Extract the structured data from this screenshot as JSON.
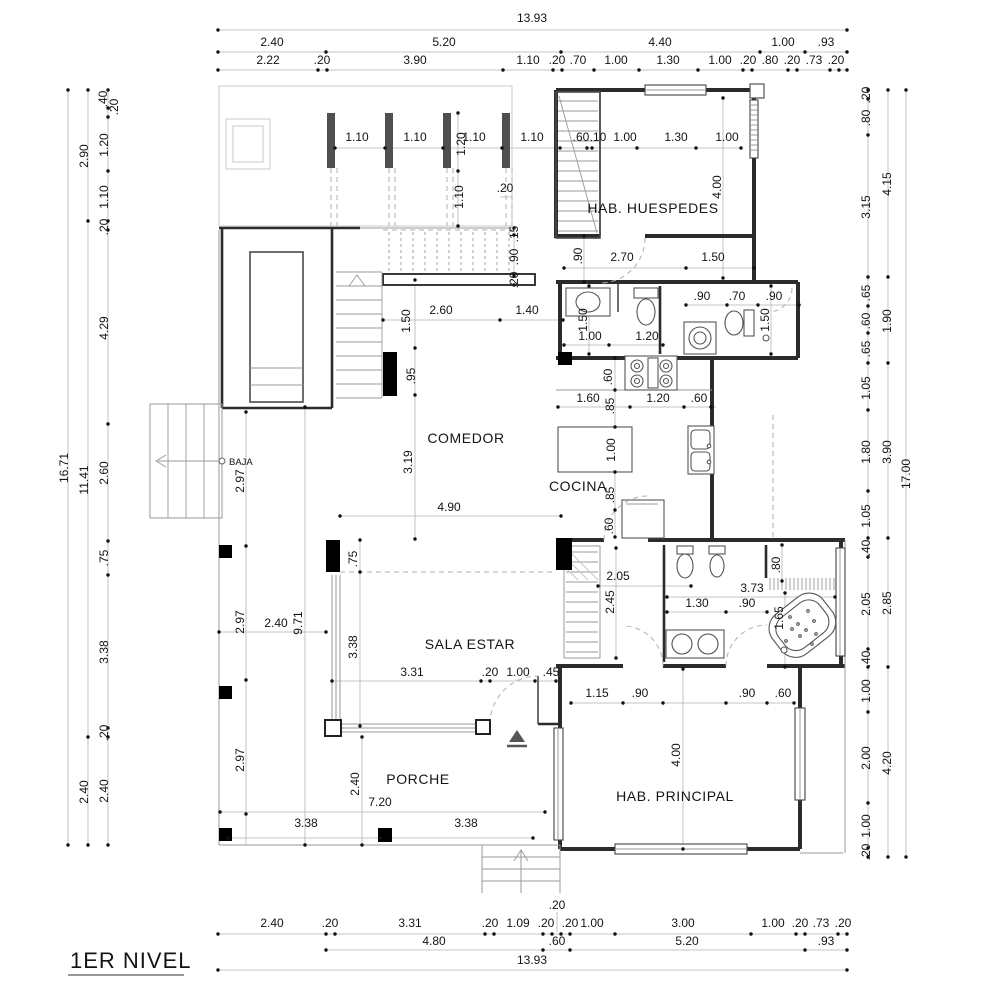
{
  "title": "1ER NIVEL",
  "colors": {
    "background": "#ffffff",
    "wall": "#2b2b2b",
    "dim_line": "#b4b4b4",
    "text": "#141414",
    "column_fill": "#000000",
    "pergola_bar": "#4f4f4f"
  },
  "rooms": {
    "hab_huespedes": "HAB. HUESPEDES",
    "comedor": "COMEDOR",
    "cocina": "COCINA",
    "sala_estar": "SALA ESTAR",
    "porche": "PORCHE",
    "hab_principal": "HAB. PRINCIPAL",
    "stair_note": "BAJA"
  },
  "dims": {
    "top_total": "13.93",
    "top_row2": [
      "2.40",
      "5.20",
      "4.40",
      "1.00",
      ".93"
    ],
    "top_row3": [
      "2.22",
      ".20",
      "3.90",
      "1.10",
      ".20",
      ".70",
      "1.00",
      "1.30",
      "1.00",
      ".20",
      ".80",
      ".20",
      ".73",
      ".20"
    ],
    "bottom_row1": [
      "2.40",
      ".20",
      "3.31",
      ".20",
      "1.09",
      ".20",
      ".20",
      ".20",
      "1.00",
      "3.00",
      "1.00",
      ".20",
      ".73",
      ".20"
    ],
    "bottom_row2": [
      "4.80",
      ".60",
      "5.20",
      ".93"
    ],
    "bottom_total": "13.93",
    "left_outer": "16.71",
    "left_mid": [
      "2.90",
      "11.41",
      "2.40"
    ],
    "left_inner": [
      ".40",
      ".20",
      "1.20",
      "1.10",
      ".20",
      "4.29",
      "2.60",
      ".75",
      "3.38",
      ".20",
      "2.40"
    ],
    "right_outer": "17.00",
    "right_mid": [
      "4.15",
      "1.90",
      "3.90",
      "2.85",
      "4.20"
    ],
    "right_inner": [
      ".20",
      ".80",
      "3.15",
      ".65",
      ".60",
      ".65",
      "1.05",
      "1.80",
      "1.05",
      ".40",
      "2.05",
      ".40",
      "1.00",
      "2.00",
      "1.00",
      ".20"
    ],
    "interior": [
      "1.10",
      "1.10",
      "1.10",
      "1.10",
      "1.20",
      "1.10",
      ".20",
      ".60",
      ".10",
      "1.00",
      "1.30",
      "1.00",
      "4.00",
      ".90",
      "2.70",
      "1.50",
      ".15",
      ".90",
      ".20",
      "1.50",
      "1.00",
      "1.20",
      ".90",
      ".70",
      ".90",
      "1.50",
      "1.50",
      "2.60",
      "1.40",
      ".95",
      "3.19",
      "4.90",
      ".60",
      "1.60",
      ".85",
      "1.20",
      ".60",
      "1.00",
      ".85",
      ".60",
      "2.97",
      "2.97",
      "2.40",
      "9.71",
      ".75",
      "3.38",
      "3.31",
      ".20",
      "1.00",
      ".45",
      "2.05",
      "2.45",
      "3.73",
      "1.30",
      ".90",
      "1.65",
      ".80",
      "1.15",
      ".90",
      ".90",
      ".60",
      "4.00",
      "2.97",
      "2.40",
      "7.20",
      "3.38",
      "3.38"
    ]
  }
}
